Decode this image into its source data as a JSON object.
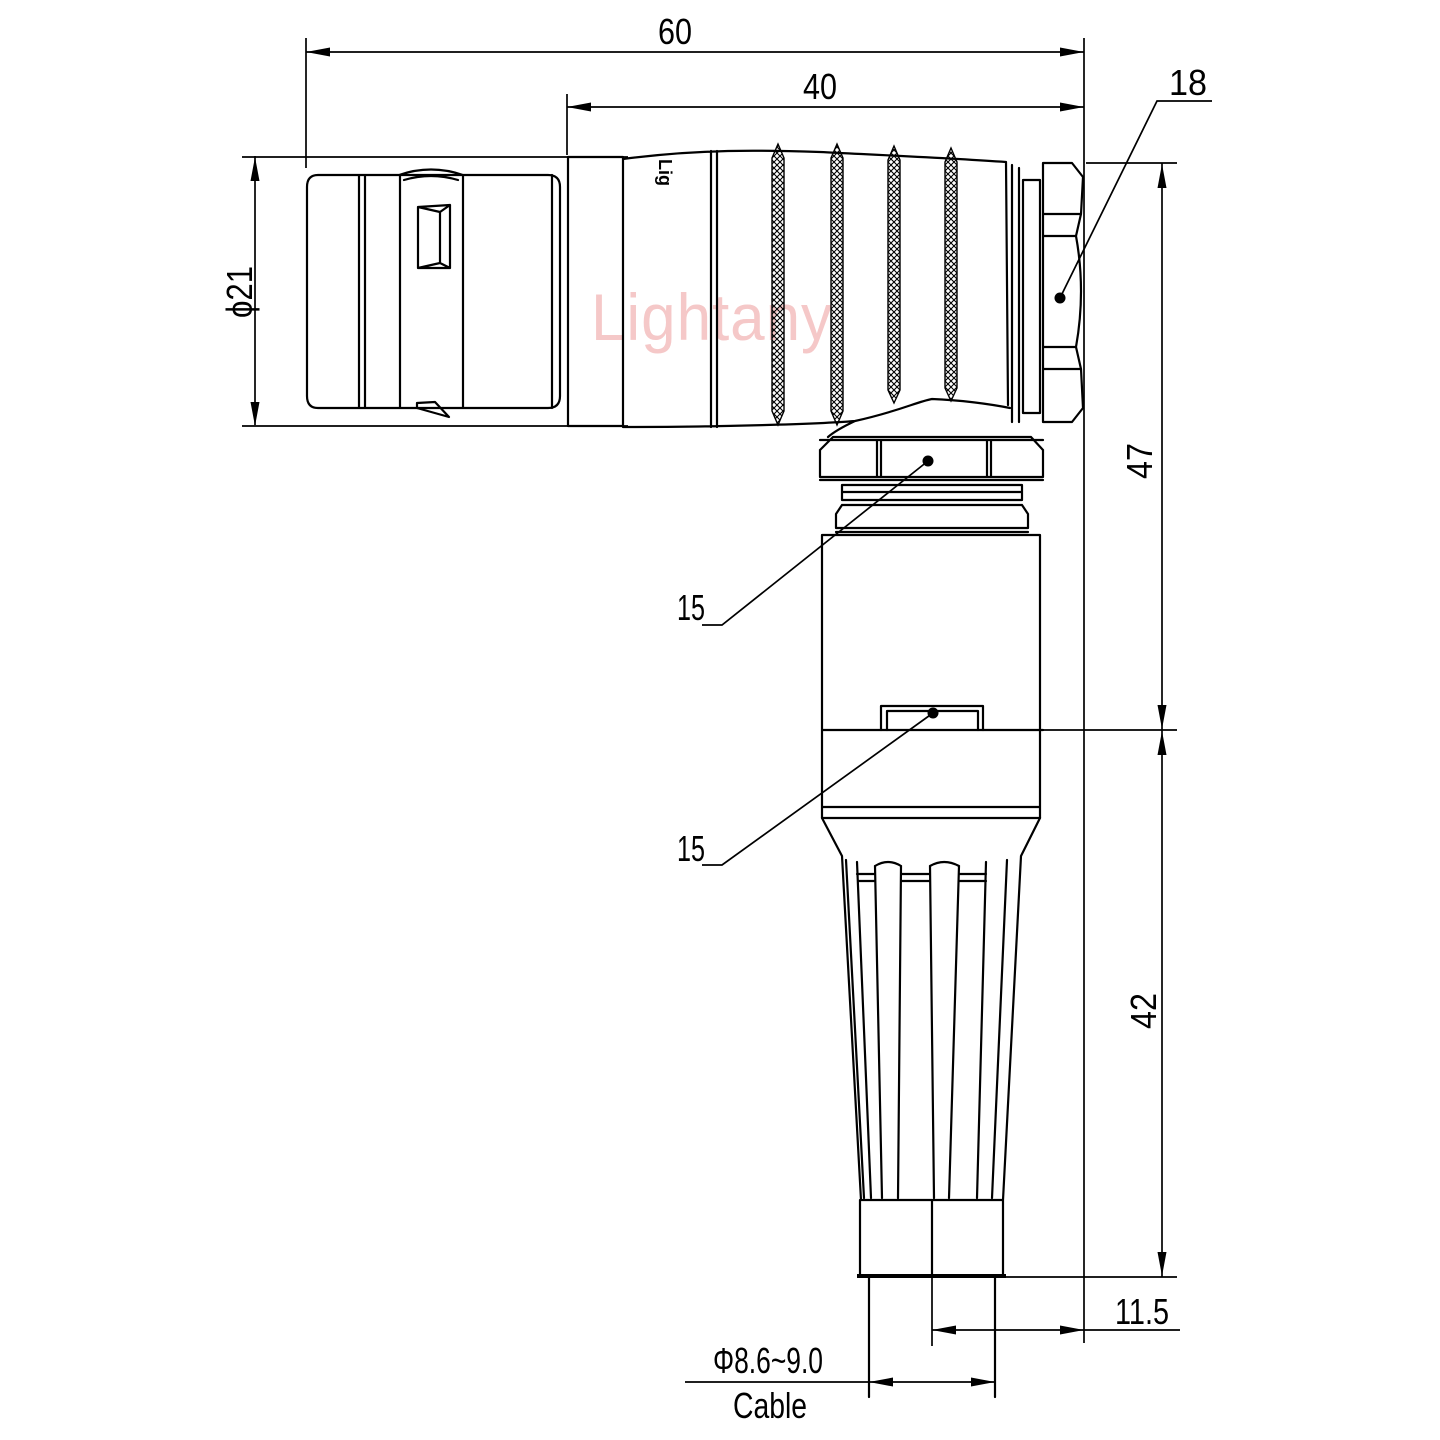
{
  "drawing": {
    "type": "connector-dimension-drawing",
    "watermark": {
      "text": "Lightany",
      "color": "#f5c8c8"
    },
    "marking": {
      "text": "Lig"
    },
    "colors": {
      "line": "#000000",
      "background": "#ffffff"
    },
    "dims": {
      "overall_length": "60",
      "front_length": "40",
      "hex_flat": "18",
      "front_dia": "ϕ21",
      "upper_height": "47",
      "ref_coupling_nut": "15",
      "ref_clip": "15",
      "lower_height": "42",
      "cable_offset": "11.5",
      "cable_dia": "Φ8.6~9.0",
      "cable_label": "Cable"
    }
  }
}
